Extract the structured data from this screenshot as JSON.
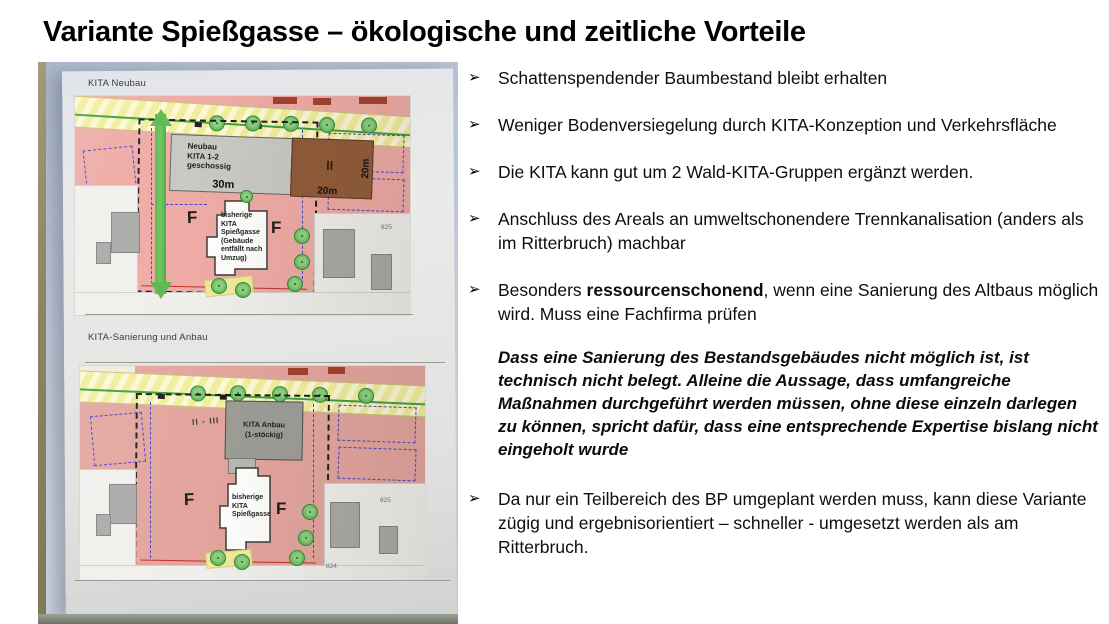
{
  "slide": {
    "title": "Variante Spießgasse – ökologische und zeitliche Vorteile"
  },
  "bullets": [
    {
      "marker": "➢",
      "text": "Schattenspendender Baumbestand bleibt erhalten"
    },
    {
      "marker": "➢",
      "text": "Weniger Bodenversiegelung durch KITA-Konzeption und Verkehrsfläche"
    },
    {
      "marker": "➢",
      "text": "Die KITA kann gut um 2 Wald-KITA-Gruppen ergänzt werden."
    },
    {
      "marker": "➢",
      "text": "Anschluss des Areals an umweltschonendere Trennkanalisation (anders als im Ritterbruch) machbar"
    },
    {
      "marker": "➢",
      "pre": "Besonders ",
      "bold": "ressourcenschonend",
      "post": ", wenn eine Sanierung des Altbaus möglich wird. Muss eine Fachfirma prüfen"
    },
    {
      "marker": "➢",
      "text": "Da nur ein Teilbereich des BP umgeplant werden muss, kann diese Variante zügig und ergebnisorientiert – schneller - umgesetzt werden als am Ritterbruch."
    }
  ],
  "note": "Dass eine Sanierung des Bestandsgebäudes nicht möglich ist, ist technisch nicht belegt. Alleine die Aussage, dass umfangreiche Maßnahmen durchgeführt werden müssen, ohne diese einzeln darlegen zu können, spricht dafür, dass eine entsprechende Expertise bislang nicht eingeholt wurde",
  "plans": {
    "plan1": {
      "label": "KITA Neubau",
      "neubau": {
        "line1": "Neubau",
        "line2": "KITA 1-2",
        "line3": "geschossig",
        "width": "30m"
      },
      "extension": {
        "storeys": "II",
        "width": "20m",
        "depth": "20m"
      },
      "old_kita": {
        "line1": "bisherige",
        "line2": "KITA",
        "line3": "Spießgasse",
        "line4": "(Gebäude",
        "line5": "entfällt nach",
        "line6": "Umzug)"
      },
      "f_left": "F",
      "f_right": "F",
      "parcel_a": "825"
    },
    "plan2": {
      "label": "KITA-Sanierung und Anbau",
      "anbau": {
        "line1": "KITA Anbau",
        "line2": "(1-stöckig)"
      },
      "storeys": "II - III",
      "old_kita": {
        "line1": "bisherige",
        "line2": "KITA",
        "line3": "Spießgasse"
      },
      "f_left": "F",
      "f_right": "F",
      "parcel_a": "825",
      "parcel_b": "824"
    }
  },
  "colors": {
    "plan_pink": "#eeaaa4",
    "road_yellow": "#f1ed9b",
    "arrow_green": "#5cb94e",
    "building_brown": "#8f5a38",
    "building_gray": "#c7c7c4",
    "photo_bg": "#bfc8d6"
  }
}
